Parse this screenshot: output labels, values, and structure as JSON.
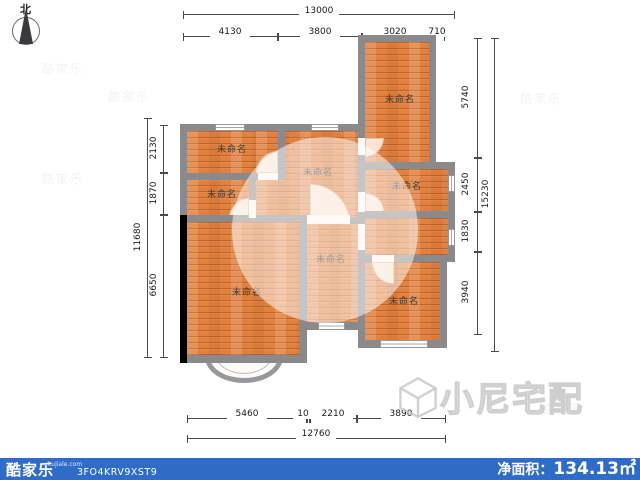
{
  "compass": {
    "north_label": "北"
  },
  "rooms": [
    {
      "id": "room-top-left",
      "name": "未命名"
    },
    {
      "id": "room-middle",
      "name": "未命名"
    },
    {
      "id": "room-left-second",
      "name": "未命名"
    },
    {
      "id": "room-top-right",
      "name": "未命名"
    },
    {
      "id": "room-right-middle",
      "name": "未命名"
    },
    {
      "id": "room-bottom-left",
      "name": "未命名"
    },
    {
      "id": "room-hall",
      "name": "未命名"
    },
    {
      "id": "room-bottom-right",
      "name": "未命名"
    }
  ],
  "dimensions": {
    "top": {
      "overall": "13000",
      "segments": [
        "4130",
        "3800",
        "3020",
        "710"
      ]
    },
    "bottom": {
      "overall": "12760",
      "segments": [
        "5460",
        "10",
        "2210",
        "3890"
      ]
    },
    "left": {
      "overall": "11680",
      "segments": [
        "2130",
        "1870",
        "6650"
      ]
    },
    "right": {
      "overall": "15230",
      "segments": [
        "5740",
        "2450",
        "1830",
        "3940"
      ]
    }
  },
  "watermark": {
    "brand": "小尼宅配",
    "tile": "酷家乐"
  },
  "footer": {
    "logo_text": "酷家乐",
    "logo_domain": "kujiale.com",
    "plan_code": "3FO4KRV9XST9",
    "net_area_label": "净面积：",
    "net_area_value": "134.13㎡"
  },
  "colors": {
    "floor_wood": "#e0813f",
    "wall_gray": "#8a8a8d",
    "selected_wall_black": "#000000",
    "footer_blue": "#2f6cc7",
    "dim_line": "#4a4a4a"
  }
}
